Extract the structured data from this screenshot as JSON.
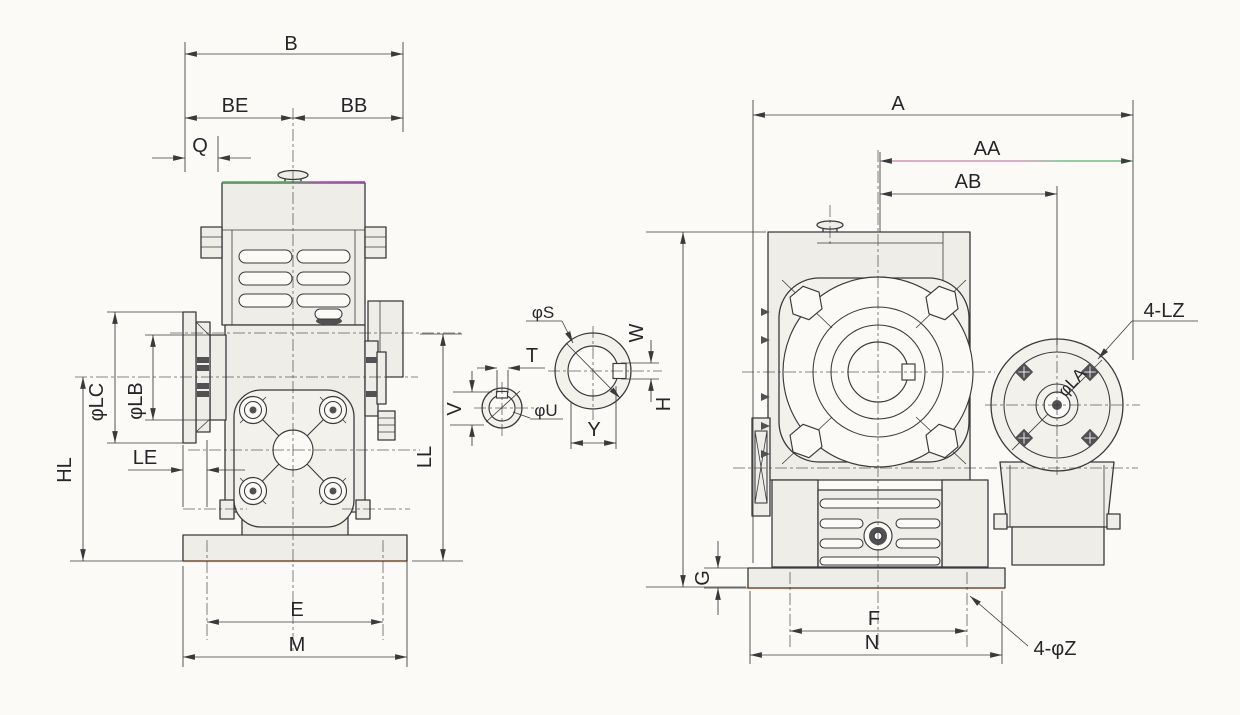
{
  "colors": {
    "paper": "#fbfaf7",
    "ink": "#3a3a3c",
    "metal": "#eeede8",
    "flange": "#f2f1ec",
    "scan_pink": "#c05f92",
    "scan_green": "#2f9e4f",
    "scan_magenta": "#a84fb0",
    "scan_orange": "#b0703c"
  },
  "views": {
    "front": {
      "dims": {
        "b": "B",
        "be": "BE",
        "bb": "BB",
        "q": "Q",
        "lc": "φLC",
        "lb": "φLB",
        "le": "LE",
        "hl": "HL",
        "ll": "LL",
        "e": "E",
        "m": "M"
      }
    },
    "shaft_sections": {
      "dims": {
        "s": "φS",
        "w": "W",
        "y": "Y",
        "t": "T",
        "v": "V",
        "u": "φU"
      }
    },
    "side": {
      "dims": {
        "a": "A",
        "aa": "AA",
        "ab": "AB",
        "h": "H",
        "g": "G",
        "f": "F",
        "n": "N",
        "lz": "4-LZ",
        "la": "φLA",
        "z": "4-φZ"
      }
    }
  }
}
